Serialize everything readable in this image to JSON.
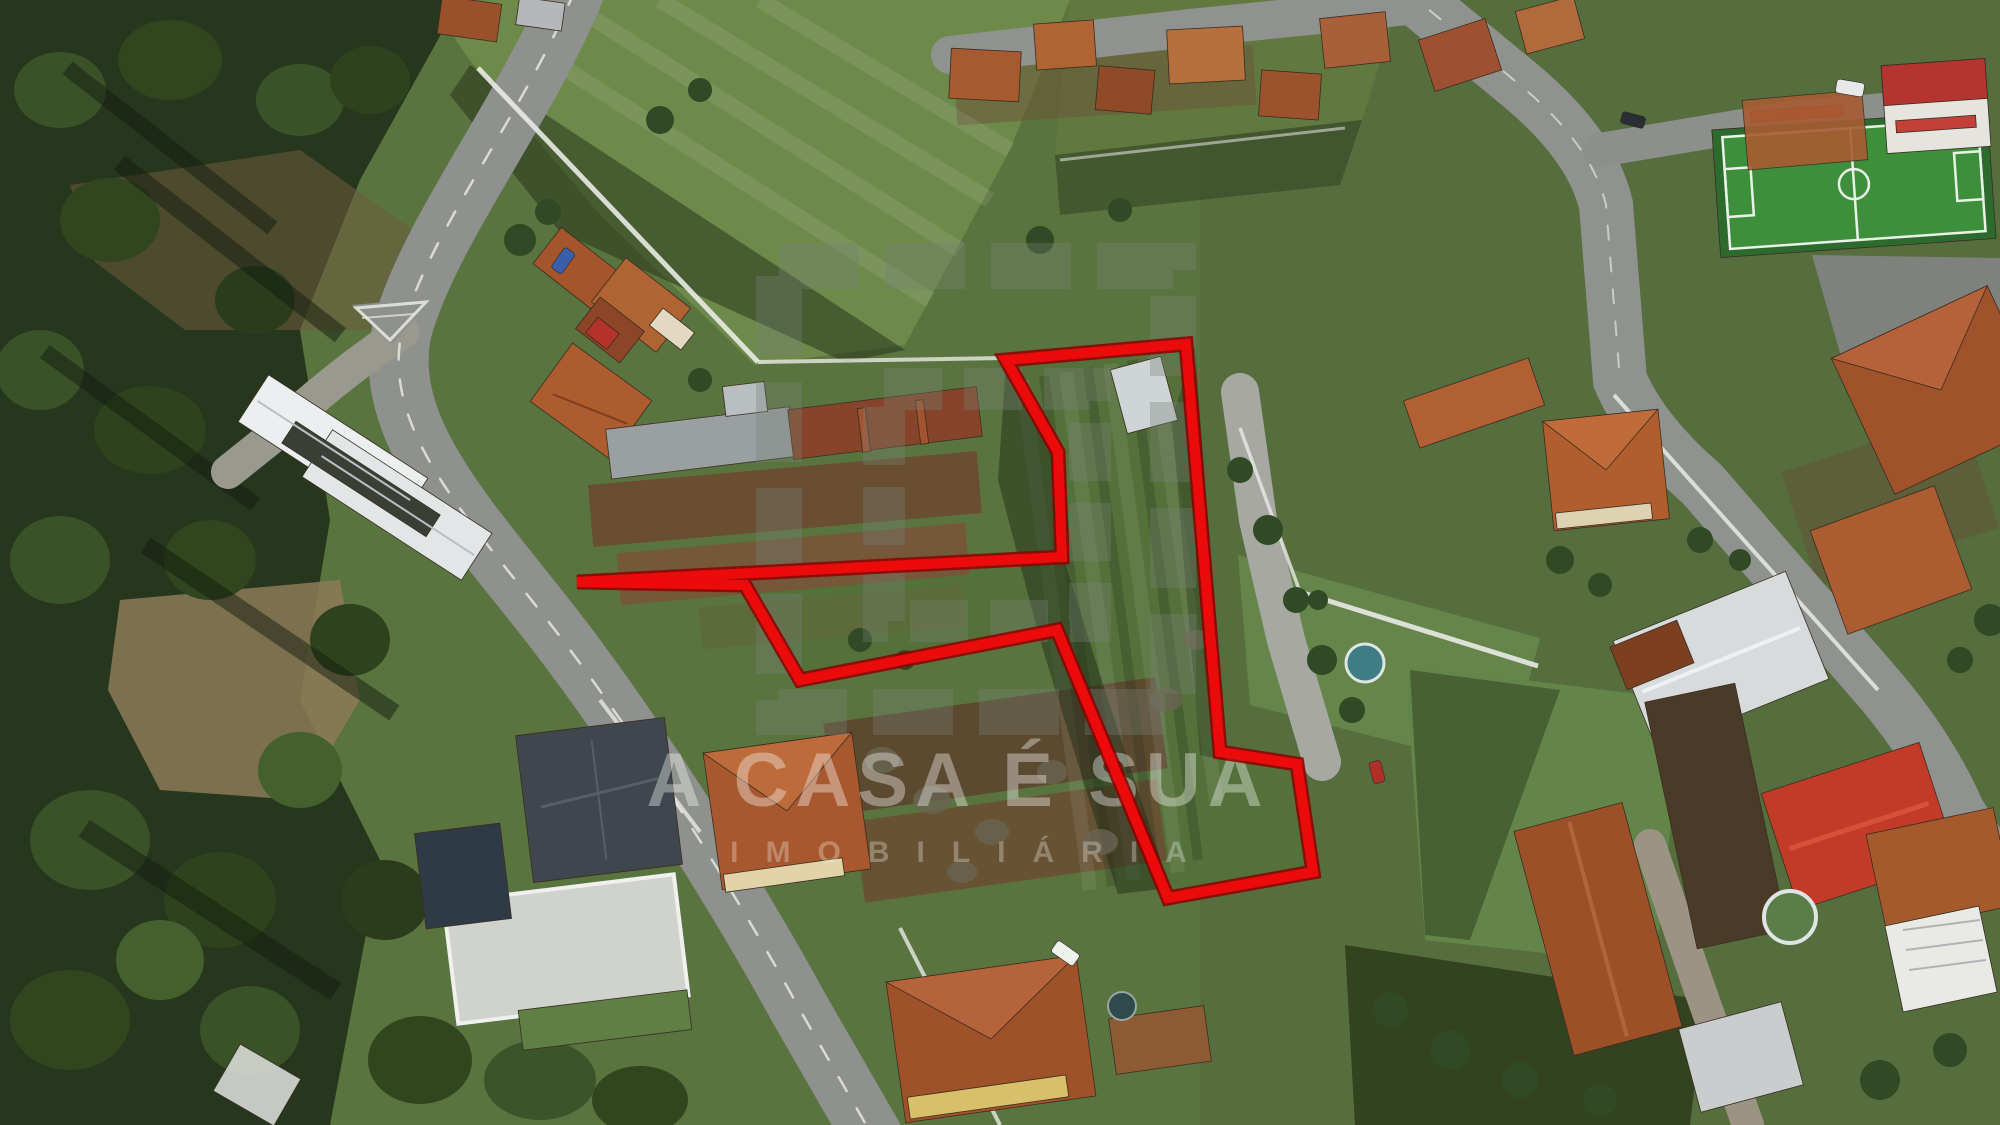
{
  "photo": {
    "kind": "aerial-drone-photograph",
    "subject": "residential village with land plot for sale outlined in red",
    "width_px": 2000,
    "height_px": 1125
  },
  "watermark": {
    "title": "A CASA É SUA",
    "subtitle": "IMOBILIÁRIA",
    "text_color": "rgba(248,250,246,0.38)",
    "subtitle_color": "rgba(248,250,246,0.30)",
    "logo_overlay_color": "rgba(120,130,118,0.34)"
  },
  "plot_annotation": {
    "outline_color": "#ec0b0b",
    "outline_casing_color": "#8f0000",
    "points": "1006,360 1186,344 1220,752 1297,764 1313,872 1168,898 1057,630 800,680 745,585 577,582 1062,557 1058,452"
  },
  "palette": {
    "field_green": "#5a743f",
    "meadow_green": "#6d8a4b",
    "parcel_green": "#54713a",
    "forest_green": "#27371e",
    "road_gray": "#8f918e",
    "roof_terracotta": "#a8582e",
    "roof_rust": "#7c4126",
    "roof_red_shed": "#c23b28",
    "roof_slate": "#3f464d",
    "wall_white": "#e9eae6",
    "pitch_turf": "#3e8f3c",
    "pool_blue": "#3e7d86",
    "pool_green_water": "#5a7d4a"
  }
}
